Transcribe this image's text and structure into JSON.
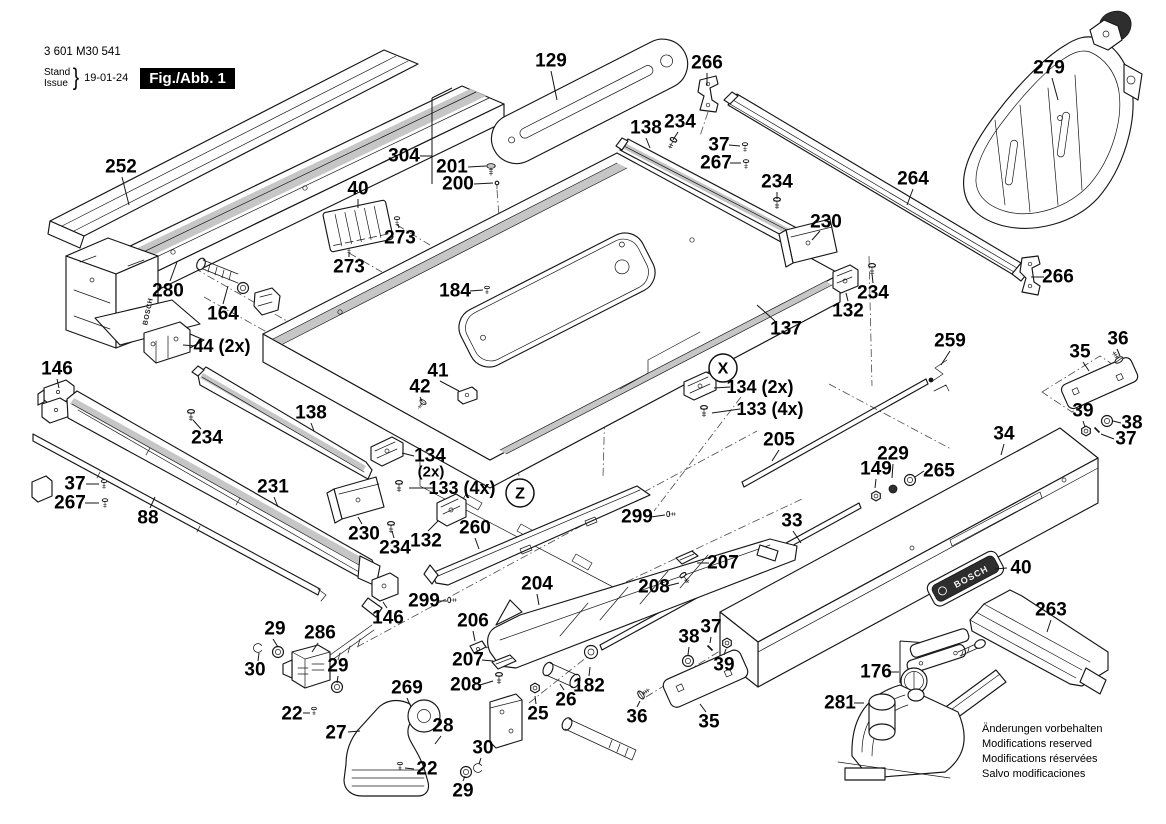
{
  "doc": {
    "part_number": "3 601 M30 541",
    "stand_label": "Stand",
    "issue_label": "Issue",
    "date": "19-01-24",
    "figure_label": "Fig./Abb. 1",
    "brand": "BOSCH",
    "footer_lines": [
      "Änderungen vorbehalten",
      "Modifications reserved",
      "Modifications réservées",
      "Salvo modificaciones"
    ]
  },
  "colors": {
    "ink": "#161616",
    "paper": "#ffffff",
    "hatch": "#c6c6c6"
  },
  "markers": [
    {
      "id": "X",
      "t": "X",
      "x": 723,
      "y": 368,
      "r": 14
    },
    {
      "id": "Z",
      "t": "Z",
      "x": 520,
      "y": 493,
      "r": 14
    }
  ],
  "callouts": [
    {
      "id": "252",
      "t": "252",
      "x": 121,
      "y": 167,
      "lines": [
        [
          122,
          177,
          129,
          205
        ]
      ]
    },
    {
      "id": "129",
      "t": "129",
      "x": 551,
      "y": 61,
      "lines": [
        [
          551,
          71,
          557,
          100
        ]
      ]
    },
    {
      "id": "304",
      "t": "304",
      "x": 404,
      "y": 156,
      "lines": [
        [
          420,
          156,
          432,
          156
        ],
        [
          432,
          98,
          432,
          184
        ],
        [
          432,
          98,
          452,
          88
        ]
      ]
    },
    {
      "id": "201",
      "t": "201",
      "x": 452,
      "y": 167,
      "lines": [
        [
          468,
          167,
          486,
          166
        ]
      ]
    },
    {
      "id": "200",
      "t": "200",
      "x": 458,
      "y": 184,
      "lines": [
        [
          474,
          184,
          493,
          183
        ]
      ]
    },
    {
      "id": "266a",
      "t": "266",
      "x": 707,
      "y": 63,
      "lines": [
        [
          707,
          73,
          707,
          86
        ]
      ]
    },
    {
      "id": "279",
      "t": "279",
      "x": 1049,
      "y": 68,
      "lines": [
        [
          1052,
          78,
          1058,
          100
        ]
      ]
    },
    {
      "id": "138a",
      "t": "138",
      "x": 646,
      "y": 128,
      "lines": [
        [
          646,
          138,
          650,
          148
        ]
      ]
    },
    {
      "id": "234a",
      "t": "234",
      "x": 680,
      "y": 122,
      "lines": [
        [
          678,
          132,
          673,
          140
        ]
      ]
    },
    {
      "id": "37a",
      "t": "37",
      "x": 719,
      "y": 145,
      "lines": [
        [
          729,
          145,
          740,
          146
        ]
      ]
    },
    {
      "id": "267a",
      "t": "267",
      "x": 716,
      "y": 163,
      "lines": [
        [
          730,
          163,
          741,
          163
        ]
      ]
    },
    {
      "id": "234b",
      "t": "234",
      "x": 777,
      "y": 182,
      "lines": [
        [
          777,
          192,
          777,
          199
        ]
      ]
    },
    {
      "id": "264",
      "t": "264",
      "x": 913,
      "y": 179,
      "lines": [
        [
          913,
          189,
          907,
          205
        ]
      ]
    },
    {
      "id": "230a",
      "t": "230",
      "x": 826,
      "y": 222,
      "lines": [
        [
          820,
          231,
          812,
          240
        ]
      ]
    },
    {
      "id": "266b",
      "t": "266",
      "x": 1058,
      "y": 277,
      "lines": [
        [
          1044,
          277,
          1031,
          277
        ]
      ]
    },
    {
      "id": "234c",
      "t": "234",
      "x": 873,
      "y": 293,
      "lines": [
        [
          873,
          283,
          872,
          274
        ]
      ]
    },
    {
      "id": "132a",
      "t": "132",
      "x": 848,
      "y": 311,
      "lines": [
        [
          848,
          301,
          846,
          293
        ]
      ]
    },
    {
      "id": "40a",
      "t": "40",
      "x": 358,
      "y": 189,
      "lines": [
        [
          358,
          199,
          358,
          208
        ]
      ]
    },
    {
      "id": "273a",
      "t": "273",
      "x": 400,
      "y": 238,
      "lines": [
        [
          399,
          228,
          398,
          224
        ]
      ]
    },
    {
      "id": "273b",
      "t": "273",
      "x": 349,
      "y": 267,
      "lines": [
        [
          349,
          257,
          349,
          252
        ]
      ]
    },
    {
      "id": "280",
      "t": "280",
      "x": 168,
      "y": 291,
      "lines": [
        [
          170,
          281,
          177,
          262
        ]
      ]
    },
    {
      "id": "164",
      "t": "164",
      "x": 223,
      "y": 314,
      "lines": [
        [
          223,
          304,
          228,
          286
        ]
      ]
    },
    {
      "id": "44",
      "t": "44 (2x)",
      "x": 222,
      "y": 346,
      "fs": 18,
      "lines": [
        [
          196,
          346,
          183,
          345
        ]
      ]
    },
    {
      "id": "146a",
      "t": "146",
      "x": 57,
      "y": 369,
      "lines": [
        [
          57,
          379,
          59,
          388
        ]
      ]
    },
    {
      "id": "184",
      "t": "184",
      "x": 455,
      "y": 291,
      "lines": [
        [
          470,
          291,
          483,
          290
        ]
      ]
    },
    {
      "id": "137",
      "t": "137",
      "x": 786,
      "y": 329,
      "lines": [
        [
          775,
          321,
          757,
          305
        ]
      ]
    },
    {
      "id": "134r",
      "t": "134 (2x)",
      "x": 760,
      "y": 387,
      "fs": 18,
      "lines": [
        [
          730,
          387,
          714,
          388
        ]
      ]
    },
    {
      "id": "133r",
      "t": "133 (4x)",
      "x": 770,
      "y": 409,
      "fs": 18,
      "lines": [
        [
          740,
          409,
          712,
          413
        ]
      ]
    },
    {
      "id": "259",
      "t": "259",
      "x": 950,
      "y": 341,
      "lines": [
        [
          950,
          351,
          941,
          365
        ]
      ]
    },
    {
      "id": "36r",
      "t": "36",
      "x": 1118,
      "y": 339,
      "lines": [
        [
          1117,
          349,
          1120,
          356
        ]
      ]
    },
    {
      "id": "35r",
      "t": "35",
      "x": 1080,
      "y": 352,
      "lines": [
        [
          1083,
          362,
          1089,
          371
        ]
      ]
    },
    {
      "id": "39r",
      "t": "39",
      "x": 1083,
      "y": 411,
      "lines": [
        [
          1083,
          421,
          1085,
          427
        ]
      ]
    },
    {
      "id": "38r",
      "t": "38",
      "x": 1132,
      "y": 423,
      "lines": [
        [
          1121,
          423,
          1113,
          421
        ]
      ]
    },
    {
      "id": "37r",
      "t": "37",
      "x": 1126,
      "y": 439,
      "lines": [
        [
          1114,
          439,
          1101,
          434
        ]
      ]
    },
    {
      "id": "34",
      "t": "34",
      "x": 1004,
      "y": 434,
      "lines": [
        [
          1004,
          444,
          1001,
          455
        ]
      ]
    },
    {
      "id": "205",
      "t": "205",
      "x": 779,
      "y": 440,
      "lines": [
        [
          779,
          450,
          772,
          461
        ]
      ]
    },
    {
      "id": "229",
      "t": "229",
      "x": 893,
      "y": 454,
      "lines": [
        [
          893,
          464,
          892,
          478
        ]
      ]
    },
    {
      "id": "149",
      "t": "149",
      "x": 876,
      "y": 469,
      "lines": [
        [
          876,
          479,
          875,
          488
        ]
      ]
    },
    {
      "id": "265",
      "t": "265",
      "x": 939,
      "y": 471,
      "lines": [
        [
          924,
          471,
          915,
          477
        ]
      ]
    },
    {
      "id": "33",
      "t": "33",
      "x": 792,
      "y": 521,
      "lines": [
        [
          793,
          531,
          801,
          543
        ]
      ]
    },
    {
      "id": "138b",
      "t": "138",
      "x": 311,
      "y": 413,
      "lines": [
        [
          311,
          423,
          314,
          431
        ]
      ]
    },
    {
      "id": "234d",
      "t": "234",
      "x": 207,
      "y": 438,
      "lines": [
        [
          201,
          429,
          193,
          420
        ]
      ]
    },
    {
      "id": "41",
      "t": "41",
      "x": 438,
      "y": 371,
      "lines": [
        [
          440,
          381,
          459,
          391
        ]
      ]
    },
    {
      "id": "42",
      "t": "42",
      "x": 420,
      "y": 387,
      "lines": [
        [
          420,
          397,
          422,
          401
        ]
      ]
    },
    {
      "id": "134l",
      "t": "134",
      "x": 430,
      "y": 456,
      "lines": [
        [
          414,
          456,
          402,
          453
        ]
      ]
    },
    {
      "id": "134l2",
      "t": "(2x)",
      "x": 431,
      "y": 472,
      "fs": 15
    },
    {
      "id": "133l",
      "t": "133 (4x)",
      "x": 462,
      "y": 488,
      "fs": 18,
      "lines": [
        [
          433,
          488,
          409,
          488
        ]
      ]
    },
    {
      "id": "37l",
      "t": "37",
      "x": 75,
      "y": 484,
      "lines": [
        [
          86,
          484,
          99,
          484
        ]
      ]
    },
    {
      "id": "267l",
      "t": "267",
      "x": 70,
      "y": 503,
      "lines": [
        [
          85,
          503,
          99,
          503
        ]
      ]
    },
    {
      "id": "88",
      "t": "88",
      "x": 148,
      "y": 518,
      "lines": [
        [
          150,
          508,
          155,
          497
        ]
      ]
    },
    {
      "id": "231",
      "t": "231",
      "x": 273,
      "y": 487,
      "lines": [
        [
          274,
          497,
          278,
          507
        ]
      ]
    },
    {
      "id": "230b",
      "t": "230",
      "x": 364,
      "y": 534,
      "lines": [
        [
          362,
          524,
          358,
          517
        ]
      ]
    },
    {
      "id": "234e",
      "t": "234",
      "x": 395,
      "y": 548,
      "lines": [
        [
          394,
          538,
          392,
          531
        ]
      ]
    },
    {
      "id": "132b",
      "t": "132",
      "x": 426,
      "y": 541,
      "lines": [
        [
          428,
          531,
          438,
          521
        ]
      ]
    },
    {
      "id": "299a",
      "t": "299",
      "x": 424,
      "y": 601,
      "lines": [
        [
          438,
          601,
          447,
          601
        ]
      ]
    },
    {
      "id": "146b",
      "t": "146",
      "x": 388,
      "y": 618,
      "lines": [
        [
          387,
          608,
          383,
          602
        ]
      ]
    },
    {
      "id": "260",
      "t": "260",
      "x": 475,
      "y": 528,
      "lines": [
        [
          475,
          538,
          479,
          549
        ]
      ]
    },
    {
      "id": "204",
      "t": "204",
      "x": 537,
      "y": 584,
      "lines": [
        [
          537,
          594,
          539,
          605
        ]
      ]
    },
    {
      "id": "299b",
      "t": "299",
      "x": 637,
      "y": 517,
      "lines": [
        [
          651,
          517,
          665,
          515
        ]
      ]
    },
    {
      "id": "206",
      "t": "206",
      "x": 473,
      "y": 621,
      "lines": [
        [
          473,
          631,
          475,
          641
        ]
      ]
    },
    {
      "id": "207a",
      "t": "207",
      "x": 468,
      "y": 660,
      "lines": [
        [
          482,
          660,
          493,
          661
        ]
      ]
    },
    {
      "id": "208a",
      "t": "208",
      "x": 466,
      "y": 685,
      "lines": [
        [
          480,
          685,
          493,
          681
        ]
      ]
    },
    {
      "id": "207b",
      "t": "207",
      "x": 723,
      "y": 563,
      "lines": [
        [
          709,
          563,
          697,
          563
        ]
      ]
    },
    {
      "id": "208b",
      "t": "208",
      "x": 654,
      "y": 587,
      "lines": [
        [
          667,
          586,
          679,
          583
        ]
      ]
    },
    {
      "id": "182",
      "t": "182",
      "x": 589,
      "y": 686,
      "lines": [
        [
          589,
          676,
          590,
          667
        ]
      ]
    },
    {
      "id": "26",
      "t": "26",
      "x": 566,
      "y": 700,
      "lines": [
        [
          564,
          690,
          560,
          684
        ]
      ]
    },
    {
      "id": "25",
      "t": "25",
      "x": 538,
      "y": 714,
      "lines": [
        [
          536,
          704,
          535,
          696
        ]
      ]
    },
    {
      "id": "36b",
      "t": "36",
      "x": 637,
      "y": 717,
      "lines": [
        [
          637,
          707,
          640,
          701
        ]
      ]
    },
    {
      "id": "35b",
      "t": "35",
      "x": 709,
      "y": 722,
      "lines": [
        [
          706,
          712,
          700,
          704
        ]
      ]
    },
    {
      "id": "38b",
      "t": "38",
      "x": 689,
      "y": 637,
      "lines": [
        [
          689,
          647,
          688,
          655
        ]
      ]
    },
    {
      "id": "37b",
      "t": "37",
      "x": 711,
      "y": 627,
      "lines": [
        [
          711,
          637,
          710,
          643
        ]
      ]
    },
    {
      "id": "39b",
      "t": "39",
      "x": 724,
      "y": 665,
      "lines": [
        [
          724,
          655,
          726,
          649
        ]
      ]
    },
    {
      "id": "176",
      "t": "176",
      "x": 876,
      "y": 672,
      "lines": [
        [
          890,
          672,
          899,
          672
        ]
      ]
    },
    {
      "id": "281",
      "t": "281",
      "x": 840,
      "y": 703,
      "lines": [
        [
          854,
          703,
          864,
          703
        ]
      ]
    },
    {
      "id": "263",
      "t": "263",
      "x": 1051,
      "y": 610,
      "lines": [
        [
          1051,
          620,
          1047,
          632
        ]
      ]
    },
    {
      "id": "40b",
      "t": "40",
      "x": 1021,
      "y": 568,
      "lines": [
        [
          1007,
          568,
          995,
          569
        ]
      ]
    },
    {
      "id": "29a",
      "t": "29",
      "x": 275,
      "y": 629,
      "lines": [
        [
          273,
          639,
          278,
          647
        ]
      ]
    },
    {
      "id": "286",
      "t": "286",
      "x": 320,
      "y": 633,
      "lines": [
        [
          318,
          643,
          312,
          652
        ]
      ]
    },
    {
      "id": "30a",
      "t": "30",
      "x": 255,
      "y": 670,
      "lines": [
        [
          258,
          661,
          259,
          653
        ]
      ]
    },
    {
      "id": "29b",
      "t": "29",
      "x": 338,
      "y": 666,
      "lines": [
        [
          338,
          676,
          337,
          683
        ]
      ]
    },
    {
      "id": "22a",
      "t": "22",
      "x": 292,
      "y": 714,
      "lines": [
        [
          303,
          713,
          310,
          713
        ]
      ]
    },
    {
      "id": "27",
      "t": "27",
      "x": 336,
      "y": 733,
      "lines": [
        [
          348,
          732,
          360,
          731
        ]
      ]
    },
    {
      "id": "269",
      "t": "269",
      "x": 407,
      "y": 688,
      "lines": [
        [
          407,
          698,
          410,
          705
        ]
      ]
    },
    {
      "id": "28",
      "t": "28",
      "x": 443,
      "y": 726,
      "lines": [
        [
          441,
          736,
          435,
          744
        ]
      ]
    },
    {
      "id": "22b",
      "t": "22",
      "x": 427,
      "y": 769,
      "lines": [
        [
          414,
          769,
          405,
          768
        ]
      ]
    },
    {
      "id": "30b",
      "t": "30",
      "x": 483,
      "y": 748,
      "lines": [
        [
          481,
          758,
          479,
          764
        ]
      ]
    },
    {
      "id": "29c",
      "t": "29",
      "x": 463,
      "y": 791,
      "lines": [
        [
          463,
          781,
          465,
          776
        ]
      ]
    }
  ]
}
